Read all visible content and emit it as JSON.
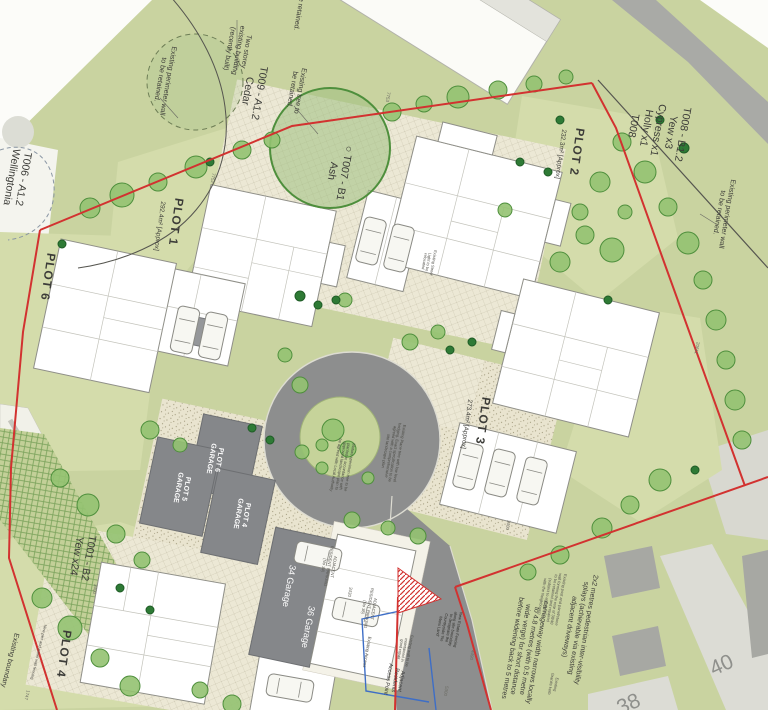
{
  "drawing": {
    "kind": "proposed site plan",
    "plots": [
      {
        "plot": "PLOT 1",
        "area": "292.4m² [Approx]"
      },
      {
        "plot": "PLOT 2",
        "area": "232.3m² [Approx]"
      },
      {
        "plot": "PLOT 3",
        "area": "273.4m² [Approx]"
      },
      {
        "plot": "PLOT 4",
        "area": ""
      },
      {
        "plot": "PLOT 6",
        "area": ""
      }
    ],
    "garages": [
      "PLOT 4 GARAGE",
      "PLOT 5 GARAGE",
      "PLOT 6 GARAGE",
      "34 Garage",
      "36 Garage"
    ],
    "tree_schedule": [
      {
        "ref": "T001 - B2",
        "species": "Yew x24"
      },
      {
        "ref": "T006 - A1.2",
        "species": "Wellingtonia"
      },
      {
        "ref": "T007 - B1",
        "species": "Ash"
      },
      {
        "ref": "T008 - B1.2",
        "species": "Yew x3, Cypress x1, Holly x1"
      },
      {
        "ref": "T009 - A1.2",
        "species": "Cedar"
      }
    ],
    "neighbour_house_numbers": [
      "38",
      "40"
    ]
  },
  "colors": {
    "site_green": "#c9d3a0",
    "lawn_green": "#d4dcab",
    "road_grey": "#8d8e8e",
    "paving_cream": "#ece8d5",
    "boundary_red": "#d23230",
    "service_blue": "#3e6ec6",
    "garage_grey": "#85878a",
    "tree_green": "#4e8f3c"
  },
  "labels": [
    {
      "name": "tree-schedule-t008",
      "lines": [
        "T008 - B1.2",
        "Yew x3",
        "Cypress x1",
        "Holly x1",
        "T008"
      ],
      "x": 658,
      "y": 130,
      "rot": 100,
      "fs": 10.5
    },
    {
      "name": "note-perimeter-wall-right",
      "lines": [
        "Existing perimeter wall",
        "to be retained."
      ],
      "x": 722,
      "y": 213,
      "rot": 100,
      "fs": 7
    },
    {
      "name": "note-two-storey-building",
      "lines": [
        "Two storey",
        "existing building",
        "(recently built)"
      ],
      "x": 237,
      "y": 50,
      "rot": 100,
      "fs": 7
    },
    {
      "name": "note-fragment-top",
      "lines": [
        "be retained."
      ],
      "x": 298,
      "y": 12,
      "rot": 100,
      "fs": 7
    },
    {
      "name": "tree-label-t009",
      "lines": [
        "T009 - A1.2",
        "Cedar"
      ],
      "x": 253,
      "y": 92,
      "rot": 100,
      "fs": 10.5
    },
    {
      "name": "note-existing-tree",
      "lines": [
        "Existing tree to",
        "be retained."
      ],
      "x": 295,
      "y": 90,
      "rot": 100,
      "fs": 7
    },
    {
      "name": "note-perimeter-wall-left",
      "lines": [
        "Existing perimeter wall",
        "to be retained."
      ],
      "x": 163,
      "y": 80,
      "rot": 100,
      "fs": 7
    },
    {
      "name": "tree-label-t006",
      "lines": [
        "T006 - A1.2",
        "Wellingtonia"
      ],
      "x": 17,
      "y": 178,
      "rot": 100,
      "fs": 10.5
    },
    {
      "name": "plot-1-title",
      "lines": [
        "PLOT 1"
      ],
      "x": 176,
      "y": 222,
      "rot": 98,
      "fs": 12,
      "bold": true,
      "ls": 1
    },
    {
      "name": "plot-1-area",
      "lines": [
        "292.4m² [Approx]"
      ],
      "x": 159,
      "y": 226,
      "rot": 98,
      "fs": 6.5
    },
    {
      "name": "plot-2-title",
      "lines": [
        "PLOT 2"
      ],
      "x": 577,
      "y": 152,
      "rot": 98,
      "fs": 12,
      "bold": true,
      "ls": 1
    },
    {
      "name": "plot-2-area",
      "lines": [
        "232.3m² [Approx]"
      ],
      "x": 560,
      "y": 154,
      "rot": 98,
      "fs": 6.5
    },
    {
      "name": "plot-3-title",
      "lines": [
        "PLOT 3"
      ],
      "x": 483,
      "y": 421,
      "rot": 98,
      "fs": 12,
      "bold": true,
      "ls": 1
    },
    {
      "name": "plot-3-area",
      "lines": [
        "273.4m² [Approx]"
      ],
      "x": 466,
      "y": 424,
      "rot": 98,
      "fs": 6.5
    },
    {
      "name": "plot-6-title",
      "lines": [
        "PLOT 6"
      ],
      "x": 48,
      "y": 277,
      "rot": 98,
      "fs": 12,
      "bold": true,
      "ls": 1
    },
    {
      "name": "plot-4-title",
      "lines": [
        "PLOT 4"
      ],
      "x": 64,
      "y": 654,
      "rot": 98,
      "fs": 12,
      "bold": true,
      "ls": 1
    },
    {
      "name": "tree-label-t007",
      "lines": [
        "○ T007 - B1",
        "Ash"
      ],
      "x": 338,
      "y": 172,
      "rot": 100,
      "fs": 10.5
    },
    {
      "name": "tree-label-t001",
      "lines": [
        "T001 - B2",
        "Yew x24"
      ],
      "x": 82,
      "y": 557,
      "rot": 100,
      "fs": 10.5
    },
    {
      "name": "garage-plot-6-label",
      "lines": [
        "PLOT 6",
        "GARAGE"
      ],
      "x": 214,
      "y": 459,
      "rot": 100,
      "fs": 7,
      "color": "#ffffff",
      "bold": true
    },
    {
      "name": "garage-plot-5-label",
      "lines": [
        "PLOT 5",
        "GARAGE"
      ],
      "x": 181,
      "y": 488,
      "rot": 100,
      "fs": 7,
      "color": "#ffffff",
      "bold": true
    },
    {
      "name": "garage-plot-4-label",
      "lines": [
        "PLOT 4",
        "GARAGE"
      ],
      "x": 241,
      "y": 514,
      "rot": 100,
      "fs": 7,
      "color": "#ffffff",
      "bold": true
    },
    {
      "name": "garage-34-label",
      "lines": [
        "34 Garage"
      ],
      "x": 289,
      "y": 586,
      "rot": 100,
      "fs": 9,
      "color": "#ffffff"
    },
    {
      "name": "garage-36-label",
      "lines": [
        "36 Garage"
      ],
      "x": 308,
      "y": 627,
      "rot": 100,
      "fs": 9,
      "color": "#ffffff"
    },
    {
      "name": "parking-34-note",
      "lines": [
        "ADJACENT",
        "RESIDENT PARKING",
        "(No 34)"
      ],
      "x": 328,
      "y": 566,
      "rot": 100,
      "fs": 4.2,
      "color": "#55544e"
    },
    {
      "name": "parking-36-note",
      "lines": [
        "ADJACENT",
        "RESIDENT PARKING",
        "(No 36)"
      ],
      "x": 368,
      "y": 608,
      "rot": 100,
      "fs": 4.2,
      "color": "#55544e"
    },
    {
      "name": "house-number-40",
      "lines": [
        "40"
      ],
      "x": 722,
      "y": 666,
      "rot": -24,
      "fs": 21,
      "color": "#8f908c"
    },
    {
      "name": "house-number-38",
      "lines": [
        "38"
      ],
      "x": 629,
      "y": 705,
      "rot": -24,
      "fs": 21,
      "color": "#8f908c"
    },
    {
      "name": "note-visibility-splays",
      "lines": [
        "2x2 metres pedestrian inter-visibility",
        "splays (achievable via existing",
        "adjacent driveways)"
      ],
      "x": 577,
      "y": 628,
      "rot": 100,
      "fs": 7
    },
    {
      "name": "note-carriageway",
      "lines": [
        "carriageway width narrows locally",
        "to 4.8 metres (with 0.5 metre",
        "wide verge) for short distance",
        "before widening back to 5 metres"
      ],
      "x": 524,
      "y": 650,
      "rot": 100,
      "fs": 7
    },
    {
      "name": "note-rear-fence",
      "lines": [
        "Existing post and panel/stone",
        "wall forming the rear of 38/40",
        "to be retained and repaired",
        "(subject to agreement",
        "with the Neighbours)"
      ],
      "x": 551,
      "y": 598,
      "rot": 100,
      "fs": 4,
      "color": "#55544e"
    },
    {
      "name": "note-granite-kerb",
      "lines": [
        "Existing",
        "Granite kerb"
      ],
      "x": 553,
      "y": 684,
      "rot": 100,
      "fs": 4,
      "color": "#55544e"
    },
    {
      "name": "note-plane-tree",
      "lines": [
        "Existing Plane tree with low level",
        "hedging. Exact specification to be",
        "agreed with a comprehensive",
        "site landscape plan"
      ],
      "x": 392,
      "y": 452,
      "rot": 100,
      "fs": 4,
      "color": "#4a4a44"
    },
    {
      "name": "note-island-tree",
      "lines": [
        "Mature specimen tree to be",
        "planted in accordance with",
        "approved landscape plan to",
        "be agreed with Local Authority"
      ],
      "x": 342,
      "y": 466,
      "rot": 100,
      "fs": 4,
      "color": "#4a4a44"
    },
    {
      "name": "note-existing-boundary",
      "lines": [
        "Existing boundary"
      ],
      "x": 9,
      "y": 660,
      "rot": 104,
      "fs": 7
    },
    {
      "name": "note-pier-panel-wall",
      "lines": [
        "New pier and panel wall fencing"
      ],
      "x": 38,
      "y": 652,
      "rot": 104,
      "fs": 4,
      "color": "#55544e"
    },
    {
      "name": "note-estate-fencing",
      "lines": [
        "New Estate Fencing",
        "along site boundary",
        "to designate the",
        "Countryside 'No",
        "Mans Land'"
      ],
      "x": 448,
      "y": 628,
      "rot": 100,
      "fs": 4,
      "color": "#2e2e2a"
    },
    {
      "name": "note-existing-wall",
      "lines": [
        "Existing wall to be",
        "maintained in",
        "good repair"
      ],
      "x": 404,
      "y": 650,
      "rot": 100,
      "fs": 4,
      "color": "#4a4a44"
    },
    {
      "name": "note-residents-access",
      "lines": [
        "Adjacent",
        "Residents",
        "Access Point"
      ],
      "x": 394,
      "y": 680,
      "rot": 100,
      "fs": 5.5,
      "color": "#333333"
    },
    {
      "name": "note-existing-access",
      "lines": [
        "Existing Access"
      ],
      "x": 367,
      "y": 652,
      "rot": 100,
      "fs": 4.5,
      "color": "#4a4a44"
    },
    {
      "name": "note-street-light",
      "lines": [
        "Existing Street",
        "Light to be",
        "relocated"
      ],
      "x": 428,
      "y": 262,
      "rot": 100,
      "fs": 4,
      "color": "#55544e"
    },
    {
      "name": "dim-7753",
      "lines": [
        "7753"
      ],
      "x": 388,
      "y": 97,
      "rot": 100,
      "fs": 4.5,
      "color": "#6c6c64"
    },
    {
      "name": "dim-7752",
      "lines": [
        "7752"
      ],
      "x": 213,
      "y": 178,
      "rot": 100,
      "fs": 4.5,
      "color": "#6c6c64"
    },
    {
      "name": "dim-3400-a",
      "lines": [
        "3400"
      ],
      "x": 95,
      "y": 589,
      "rot": 100,
      "fs": 4.5,
      "color": "#6c6c64"
    },
    {
      "name": "dim-3400-b",
      "lines": [
        "3400"
      ],
      "x": 508,
      "y": 525,
      "rot": 100,
      "fs": 4.5,
      "color": "#6c6c64"
    },
    {
      "name": "dim-3430",
      "lines": [
        "3430"
      ],
      "x": 350,
      "y": 592,
      "rot": 100,
      "fs": 4.5,
      "color": "#6c6c64"
    },
    {
      "name": "dim-4490",
      "lines": [
        "4490"
      ],
      "x": 472,
      "y": 655,
      "rot": 100,
      "fs": 4.5,
      "color": "#6c6c64"
    },
    {
      "name": "dim-5300",
      "lines": [
        "5300"
      ],
      "x": 446,
      "y": 691,
      "rot": 100,
      "fs": 4.5,
      "color": "#6c6c64"
    },
    {
      "name": "dim-1747",
      "lines": [
        "1747"
      ],
      "x": 27,
      "y": 695,
      "rot": 104,
      "fs": 4.5,
      "color": "#6c6c64"
    },
    {
      "name": "dim-20611",
      "lines": [
        "20611"
      ],
      "x": 697,
      "y": 348,
      "rot": 100,
      "fs": 4.5,
      "color": "#6c6c64"
    }
  ]
}
